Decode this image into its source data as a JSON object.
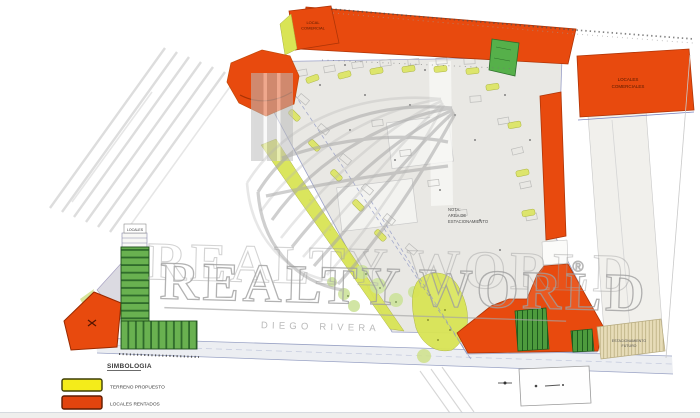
{
  "watermark": {
    "brand": "REALTY WORLD",
    "registered_mark": "®",
    "subtitle": "DIEGO RIVERA",
    "logo_icon": "globe-grid-icon",
    "color": "#9b9b9b"
  },
  "legend": {
    "title": "SIMBOLOGIA",
    "items": [
      {
        "label": "TERRENO PROPUESTO",
        "color": "#f4ec1a",
        "border_color": "#3d3d06"
      },
      {
        "label": "LOCALES RENTADOS",
        "color": "#e2440e",
        "border_color": "#5e1c00"
      }
    ]
  },
  "annotations": {
    "parcel_top_left_line1": "LOCAL",
    "parcel_top_left_line2": "COMERCIAL",
    "parcel_top_right_line1": "LOCALES",
    "parcel_top_right_line2": "COMERCIALES",
    "center_note_line1": "NOTA:",
    "center_note_line2": "AREA DE",
    "center_note_line3": "ESTACIONAMIENTO",
    "strip_label_line1": "ESTACIONAMIENTO",
    "strip_label_line2": "FUTURO",
    "building_label": "LOCALES"
  },
  "colors": {
    "orange": "#e84a0e",
    "orange_stroke": "#b03507",
    "yellow_green": "#d9e455",
    "dark_green": "#4d9b3d",
    "light_green_parcel": "#56b04a",
    "lot_gray": "#e9e8e4",
    "blue_line": "#8d96c4",
    "tan": "#e7dcb8",
    "watermark_gray": "#a3a3a3"
  }
}
